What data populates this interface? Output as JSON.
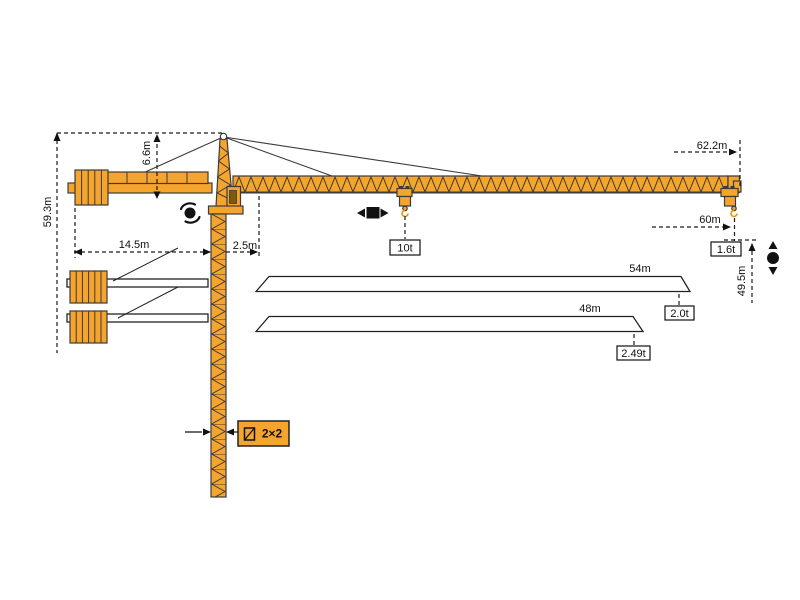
{
  "diagram": {
    "type": "tower-crane-specification-drawing",
    "dimensions": {
      "total_height": "59.3m",
      "tower_head_height": "6.6m",
      "counter_jib_length": "14.5m",
      "rear_offset": "2.5m",
      "max_jib_reach": "62.2m",
      "max_working_radius": "60m",
      "hook_height": "49.5m"
    },
    "loads": {
      "max_capacity": "10t",
      "tip_load_60m": "1.6t"
    },
    "jib_variants": [
      {
        "length": "54m",
        "tip_load": "2.0t"
      },
      {
        "length": "48m",
        "tip_load": "2.49t"
      }
    ],
    "mast": {
      "section_label": "2×2"
    },
    "symbols": [
      "slewing-rotation",
      "trolley-travel",
      "hoist-up-down"
    ],
    "colors": {
      "crane_orange": "#F5A42E",
      "outline": "#3B3B3B",
      "line_black": "#1A1A1A"
    }
  }
}
